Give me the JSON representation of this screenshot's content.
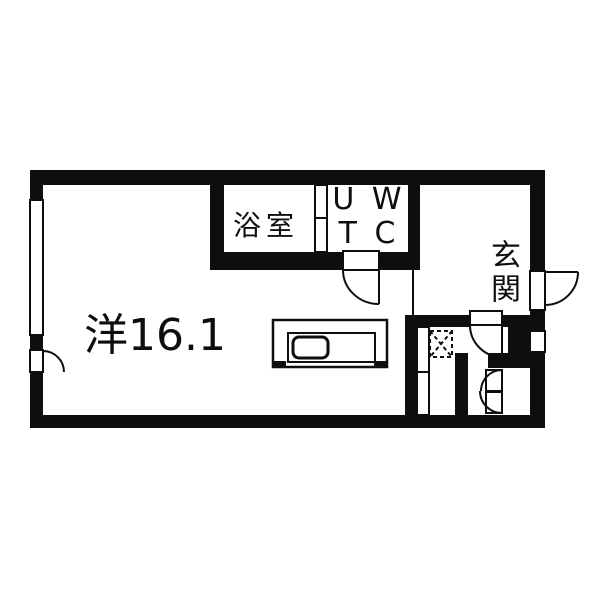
{
  "plan_title": "studio-apartment-floor-plan",
  "labels": {
    "living": "洋16.1",
    "bathroom": "浴室",
    "ut_wc_rows": [
      "U W",
      "T C"
    ],
    "entrance": "玄関"
  },
  "colors": {
    "wall": "#0e0e0e",
    "line": "#0e0e0e",
    "background": "#ffffff"
  },
  "symbols": [
    "kitchen-counter-with-sink",
    "washing-machine-space-hatched-square",
    "entrance-door-swing",
    "wc-door-swing",
    "hallway-door-swing",
    "closet-double-door-swing",
    "left-wall-window",
    "right-wall-window",
    "bathroom-sliding-door",
    "genkan-step-line"
  ]
}
